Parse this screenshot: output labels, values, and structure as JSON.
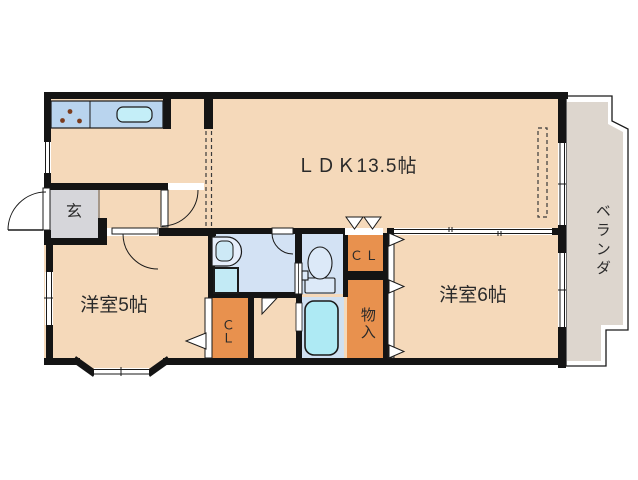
{
  "floor_plan": {
    "rooms": {
      "ldk": "ＬＤＫ13.5帖",
      "western_room_5": "洋室5帖",
      "western_room_6": "洋室6帖",
      "entrance": "玄",
      "closet_upper": "ＣＬ",
      "closet_lower": "ＣＬ",
      "storage": "物入",
      "veranda": "ベランダ"
    },
    "fixtures": [
      "gas-stove-3-burners",
      "kitchen-sink",
      "washbasin",
      "washing-machine-pan",
      "toilet",
      "bathtub"
    ],
    "colors": {
      "floor": "#f5d9ba",
      "entrance_floor": "#d6d6da",
      "closet": "#e8914e",
      "sanitary_floor": "#d3e2f4",
      "counter": "#b9d4ee",
      "water_fixture": "#b5e8f4",
      "veranda_floor": "#ddd6ce",
      "wall": "#141414"
    }
  }
}
